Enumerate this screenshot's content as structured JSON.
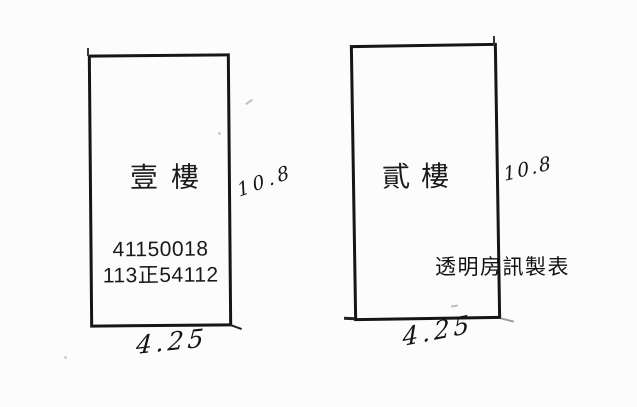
{
  "document": {
    "type": "scanned floor-plan sketch",
    "background": "#fcfcfc",
    "ink_color": "#161616",
    "watermark_text": "透明房訊製表"
  },
  "units": [
    {
      "floor_label": "壹樓",
      "registration_numbers": [
        "41150018",
        "113正54112"
      ],
      "depth_dimension": "10.8",
      "width_dimension": "4.25"
    },
    {
      "floor_label": "貳樓",
      "registration_numbers": [],
      "depth_dimension": "10.8",
      "width_dimension": "4.25"
    }
  ]
}
